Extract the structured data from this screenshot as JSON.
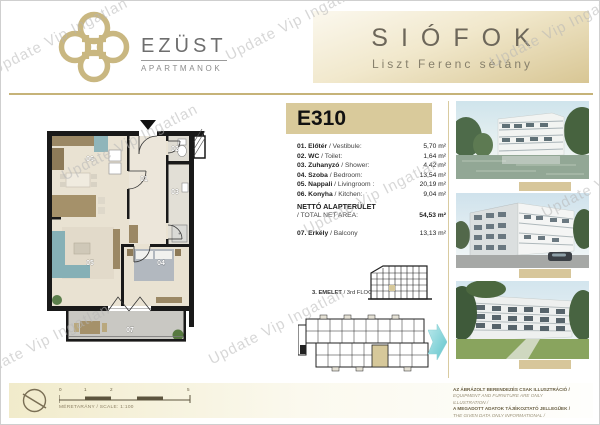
{
  "watermark": {
    "text": "Update Vip Ingatlan"
  },
  "header": {
    "brand_title": "EZÜST",
    "brand_subtitle": "APARTMANOK",
    "location_title": "SIÓFOK",
    "location_subtitle": "Liszt Ferenc sétány"
  },
  "unit": {
    "id": "E310",
    "rooms": [
      {
        "label": "01. Előtér",
        "label_en": " / Vestibule:",
        "area": "5,70 m²"
      },
      {
        "label": "02. WC",
        "label_en": " / Toilet:",
        "area": "1,64 m²"
      },
      {
        "label": "03. Zuhanyzó",
        "label_en": " / Shower:",
        "area": "4,42 m²"
      },
      {
        "label": "04. Szoba",
        "label_en": " / Bedroom:",
        "area": "13,54 m²"
      },
      {
        "label": "05. Nappali",
        "label_en": " / Livingroom :",
        "area": "20,19 m²"
      },
      {
        "label": "06. Konyha",
        "label_en": " / Kitchen:",
        "area": "9,04 m²"
      }
    ],
    "total_label": "NETTÓ ALAPTERÜLET",
    "total_label_en": "/ TOTAL NET AREA:",
    "total_area": "54,53 m²",
    "balcony_label": "07. Erkély",
    "balcony_label_en": " / Balcony",
    "balcony_area": "13,13 m²"
  },
  "plan": {
    "labels": {
      "r01": "01",
      "r02": "02",
      "r03": "03",
      "r04": "04",
      "r05": "05",
      "r06": "06",
      "r07": "07"
    }
  },
  "floor_info": {
    "label_hu": "3. EMELET",
    "label_en": " / 3rd FLOOR"
  },
  "footer": {
    "scale_ticks": [
      "0",
      "1",
      "2",
      "5"
    ],
    "scale_label": "MÉRETARÁNY / SCALE: 1:100",
    "disclaimer": [
      "AZ ÁBRÁZOLT BERENDEZÉS CSAK ILLUSZTRÁCIÓ /",
      "EQUIPMENT AND FURNITURE ARE ONLY ILLUSTRATION /",
      "A MEGADOTT ADATOK TÁJÉKOZTATÓ JELLEGŰEK /",
      "THE GIVEN DATA ONLY INFORMATIONAL /"
    ]
  },
  "colors": {
    "gold": "#c6b379",
    "tan": "#d9ca9b",
    "teal": "#74cbd1"
  }
}
